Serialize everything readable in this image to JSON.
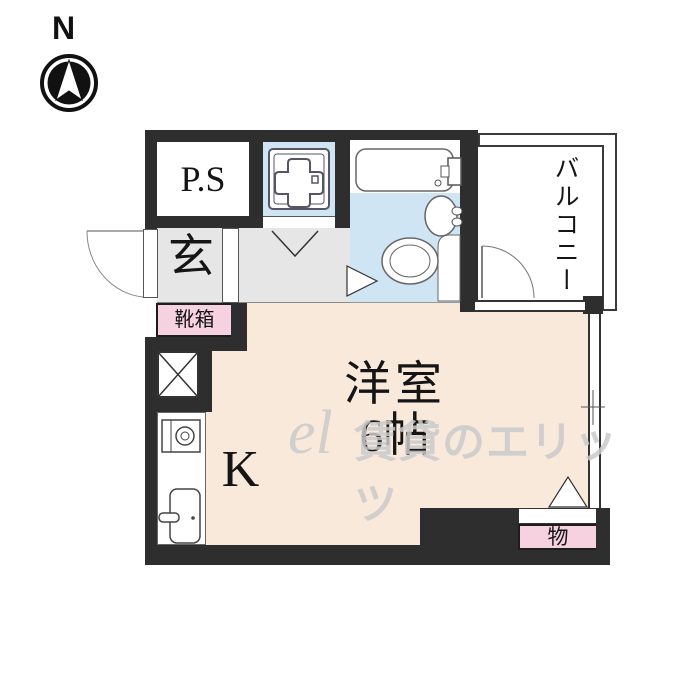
{
  "compass": {
    "north_label": "N"
  },
  "plan": {
    "pipe_space": "P.S",
    "entrance": "玄",
    "shoe_box": "靴箱",
    "balcony": "バルコニー",
    "main_room": "洋室",
    "main_room_size": "6帖",
    "kitchen": "K",
    "storage": "物"
  },
  "watermark": {
    "logo": "el",
    "text": "賃貸のエリッツ"
  },
  "colors": {
    "wall": "#2e2e2e",
    "floor_gray": "#e6e6e6",
    "floor_blue": "#cfe5f4",
    "floor_peach": "#f9e9da",
    "pink": "#f6d2e0",
    "line": "#444444",
    "watermark": "#cbcbcb"
  }
}
